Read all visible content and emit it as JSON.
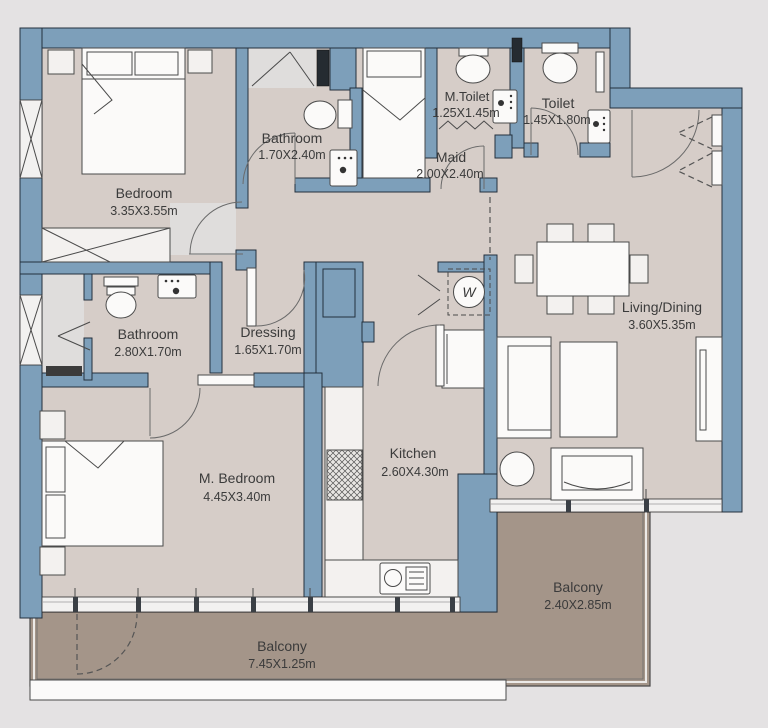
{
  "plan": {
    "type": "apartment-floor-plan",
    "rooms": {
      "bedroom": {
        "name": "Bedroom",
        "dims": "3.35X3.55m"
      },
      "bathroom_top": {
        "name": "Bathroom",
        "dims": "1.70X2.40m"
      },
      "m_toilet": {
        "name": "M.Toilet",
        "dims": "1.25X1.45m"
      },
      "toilet": {
        "name": "Toilet",
        "dims": "1.45X1.80m"
      },
      "maid": {
        "name": "Maid",
        "dims": "2.00X2.40m"
      },
      "living": {
        "name": "Living/Dining",
        "dims": "3.60X5.35m"
      },
      "bathroom_master": {
        "name": "Bathroom",
        "dims": "2.80X1.70m"
      },
      "dressing": {
        "name": "Dressing",
        "dims": "1.65X1.70m"
      },
      "m_bedroom": {
        "name": "M. Bedroom",
        "dims": "4.45X3.40m"
      },
      "kitchen": {
        "name": "Kitchen",
        "dims": "2.60X4.30m"
      },
      "balcony_main": {
        "name": "Balcony",
        "dims": "7.45X1.25m"
      },
      "balcony_living": {
        "name": "Balcony",
        "dims": "2.40X2.85m"
      }
    },
    "symbols": {
      "washer": "W"
    },
    "colors": {
      "background": "#e4e2e3",
      "wall": "#7d9fba",
      "wall_outline": "#24303d",
      "floor": "#d6cdc8",
      "floor_light": "#dfdddc",
      "balcony_floor": "#a49589",
      "furniture": "#f3f1ef",
      "text": "#3b3b3b"
    }
  }
}
